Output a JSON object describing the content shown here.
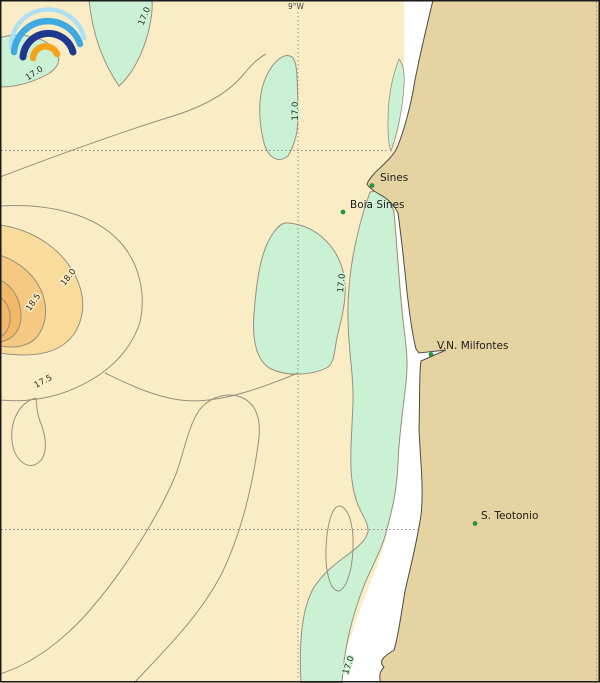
{
  "map_meta": {
    "meridian_label": "9°W"
  },
  "places": [
    {
      "label": "Sines"
    },
    {
      "label": "Boia Sines"
    },
    {
      "label": "V.N. Milfontes"
    },
    {
      "label": "S. Teotonio"
    }
  ],
  "contour_labels": [
    "17.0",
    "17.0",
    "17.0",
    "17.0",
    "17.0",
    "17.5",
    "18.0",
    "18.5"
  ],
  "colors": {
    "sea": "#FAEDC6",
    "cold_water": "#CBF1D4",
    "land": "#E5D3A2",
    "no_data_strip": "#FFFFFF",
    "warm_band_18": "#F9DB9C",
    "warm_band_18_5": "#F5C981",
    "warm_core": "#F1B966",
    "contour_line": "#97907E",
    "coastline": "#4C4C46",
    "grid_line": "#8C8C8C",
    "marker_green": "#1FA13A",
    "marker_edge": "#0E6B22",
    "logo_pale_blue": "#AEE0F5",
    "logo_light_blue": "#3FA9E0",
    "logo_navy": "#20398F",
    "logo_orange": "#F6A31C",
    "border": "#1a1a1a"
  }
}
